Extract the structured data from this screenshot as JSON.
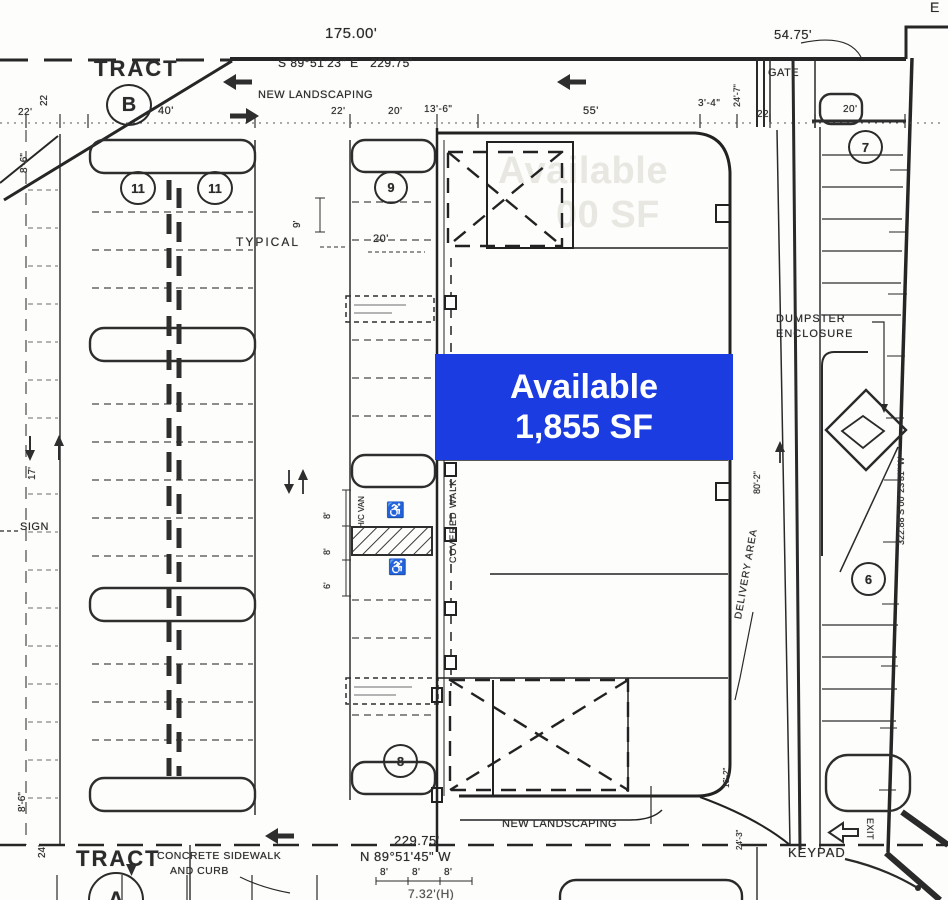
{
  "badge": {
    "line1": "Available",
    "line2": "1,855 SF",
    "bg_color": "#1b3ce0",
    "text_color": "#ffffff"
  },
  "ghost_badge": {
    "line1": "Available",
    "line2": "00 SF"
  },
  "survey": {
    "top_length": "175.00'",
    "top_bearing": "S 89°51'23\" E   229.75'",
    "ne_length": "54.75'",
    "ne_corner_note": "E",
    "east_bearing": "322.88  S 00°23'31\" W",
    "south_length": "229.75'",
    "south_bearing": "N 89°51'45\" W"
  },
  "tracts": {
    "north": {
      "word": "TRACT",
      "id": "B"
    },
    "south": {
      "word": "TRACT",
      "id": "A"
    }
  },
  "site_labels": {
    "new_landscaping_top": "NEW LANDSCAPING",
    "new_landscaping_bottom": "NEW LANDSCAPING",
    "gate": "GATE",
    "typical": "TYPICAL",
    "sign": "SIGN",
    "covered_walk": "COVERED WALK",
    "delivery_area": "DELIVERY AREA",
    "dumpster_line1": "DUMPSTER",
    "dumpster_line2": "ENCLOSURE",
    "keypad": "KEYPAD",
    "exit": "EXIT",
    "concrete_line1": "CONCRETE SIDEWALK",
    "concrete_line2": "AND CURB",
    "hc_van": "H/C VAN",
    "height_note": "7.32'(H)"
  },
  "dimensions": {
    "w22_left": "22'",
    "w22_left_vert": "22",
    "w40": "40'",
    "w22_mid": "22'",
    "w20_mid": "20'",
    "w13_6": "13'-6\"",
    "w55": "55'",
    "w3_4": "3'-4\"",
    "w24_7": "24'-7\"",
    "w22_right": "22",
    "w20_right": "20'",
    "h8_6_top": "8'-6\"",
    "h17": "17'",
    "h9": "9'",
    "w20_typical": "20'",
    "h8_a": "8'",
    "h8_b": "8'",
    "h6": "6'",
    "h80_2": "80'-2\"",
    "h16_2": "16'-2\"",
    "h24_3": "24'-3\"",
    "h8_6_bottom": "8'-6\"",
    "h24_bottom": "24'",
    "s8_a": "8'",
    "s8_b": "8'",
    "s8_c": "8'"
  },
  "stall_tags": {
    "left_a": "11",
    "left_b": "11",
    "center_top": "9",
    "center_bottom": "8",
    "right_top": "7",
    "right_mid": "6"
  },
  "icons": {
    "handicap": "♿"
  }
}
